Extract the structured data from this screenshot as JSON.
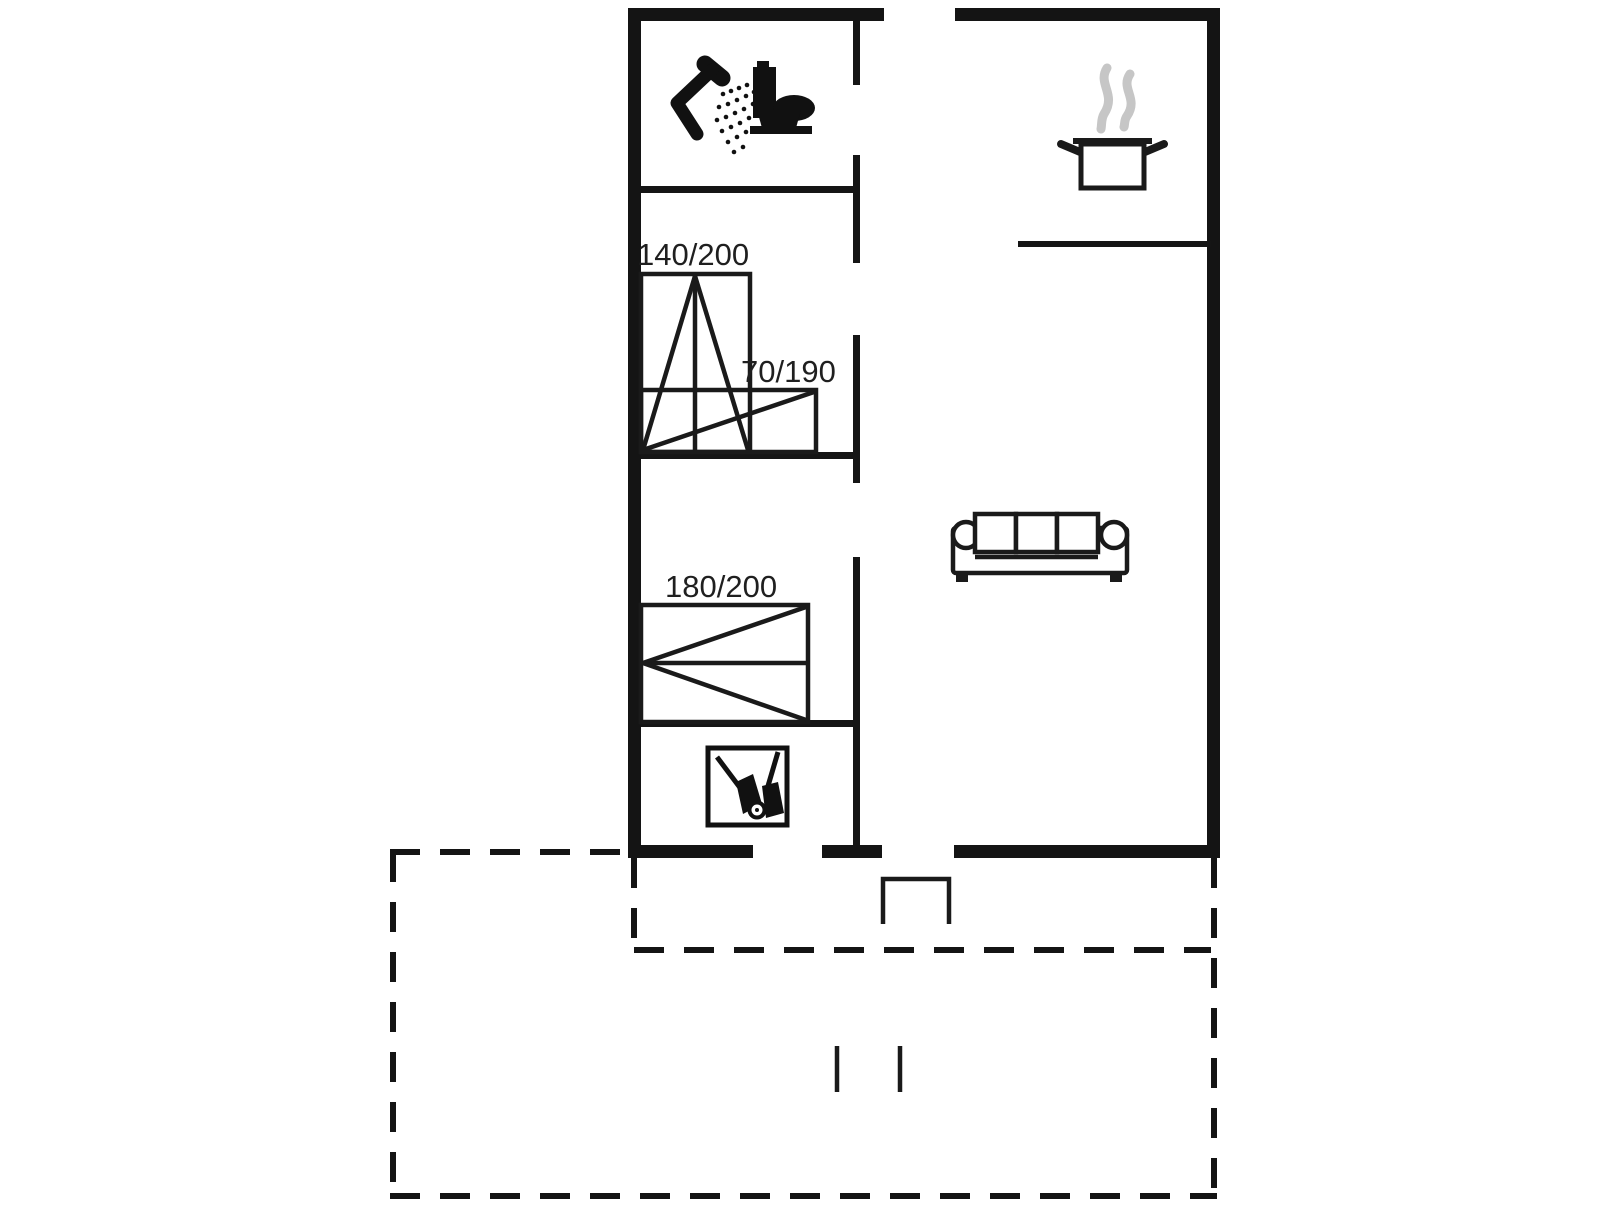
{
  "floor_plan": {
    "background_color": "#ffffff",
    "wall_color": "#141414",
    "line_color": "#1a1a1a",
    "steam_color": "#c6c6c6",
    "rooms": {
      "bathroom": {
        "icons": [
          "shower-icon",
          "toilet-icon"
        ]
      },
      "kitchen": {
        "icons": [
          "cooking-pot-icon"
        ]
      },
      "living_room": {
        "icons": [
          "sofa-icon"
        ]
      },
      "utility": {
        "icons": [
          "cleaning-equipment-icon"
        ]
      },
      "terrace": {
        "style": "dashed-outline"
      }
    },
    "beds": [
      {
        "name": "double-bed",
        "size_label": "140/200"
      },
      {
        "name": "single-bed",
        "size_label": "70/190"
      },
      {
        "name": "double-bed-large",
        "size_label": "180/200"
      }
    ]
  }
}
